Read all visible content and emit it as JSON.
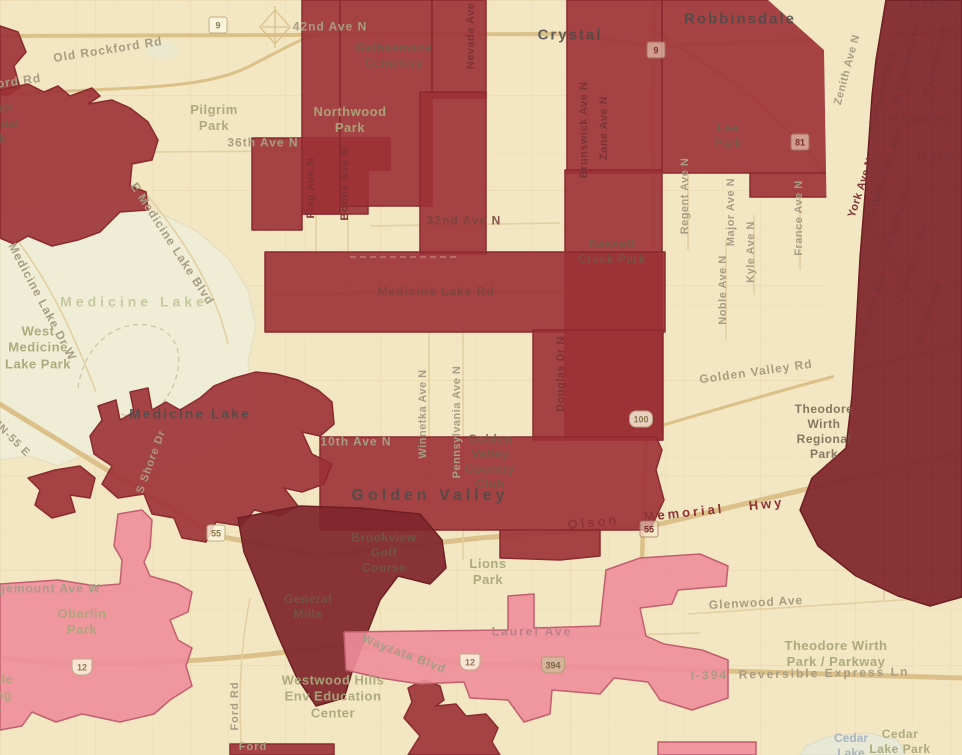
{
  "map": {
    "description": "Choropleth overlay map of Golden Valley / Crystal / Robbinsdale / Medicine Lake, Minnesota area",
    "palette": {
      "base": "#f3e6c2",
      "water": "#f0edd6",
      "region_red": "#9c3136",
      "region_red_stroke": "#8a2b30",
      "region_maroon": "#7f262c",
      "region_pink": "#ee8d9b",
      "region_pink_stroke": "#c05f6e",
      "road": "#dcc089",
      "grid": "#e8d6aa"
    }
  },
  "labels": [
    {
      "text": "Crystal",
      "x": 570,
      "y": 36,
      "rot": 0,
      "type": "city"
    },
    {
      "text": "Robbinsdale",
      "x": 740,
      "y": 20,
      "rot": 0,
      "type": "city"
    },
    {
      "text": "Medicine Lake",
      "x": 190,
      "y": 414,
      "rot": 0,
      "type": "city",
      "size": 14
    },
    {
      "text": "Golden Valley",
      "x": 430,
      "y": 496,
      "rot": 0,
      "type": "city",
      "ls": 4,
      "size": 16
    },
    {
      "text": "Pilgrim\nPark",
      "x": 214,
      "y": 118,
      "rot": 0,
      "type": "park"
    },
    {
      "text": "Northwood\nPark",
      "x": 350,
      "y": 120,
      "rot": 0,
      "type": "park"
    },
    {
      "text": "Gethsemane\nCemetery",
      "x": 394,
      "y": 56,
      "rot": 0,
      "type": "park-dark"
    },
    {
      "text": "Lee\nPark",
      "x": 728,
      "y": 136,
      "rot": 0,
      "type": "park-dark"
    },
    {
      "text": "Bassett\nCreek Park",
      "x": 612,
      "y": 252,
      "rot": 0,
      "type": "park-dark"
    },
    {
      "text": "West\nMedicine\nLake Park",
      "x": 38,
      "y": 348,
      "rot": 0,
      "type": "park"
    },
    {
      "text": "Golden\nValley\nCountry\nClub",
      "x": 490,
      "y": 462,
      "rot": 0,
      "type": "park-dark"
    },
    {
      "text": "Theodore\nWirth\nRegional\nPark",
      "x": 824,
      "y": 432,
      "rot": 0,
      "type": "park-dark"
    },
    {
      "text": "Brookview\nGolf\nCourse",
      "x": 384,
      "y": 553,
      "rot": 0,
      "type": "park-dark"
    },
    {
      "text": "Lions\nPark",
      "x": 488,
      "y": 572,
      "rot": 0,
      "type": "park"
    },
    {
      "text": "General\nMills",
      "x": 308,
      "y": 607,
      "rot": 0,
      "type": "park-dark"
    },
    {
      "text": "Westwood Hills\nEnv Education\nCenter",
      "x": 333,
      "y": 697,
      "rot": 0,
      "type": "park"
    },
    {
      "text": "Theodore Wirth\nPark / Parkway",
      "x": 836,
      "y": 654,
      "rot": 0,
      "type": "park"
    },
    {
      "text": "Oberlin\nPark",
      "x": 82,
      "y": 622,
      "rot": 0,
      "type": "park"
    },
    {
      "text": "French\nRegional\nPark",
      "x": -8,
      "y": 124,
      "rot": 0,
      "type": "park-dark"
    },
    {
      "text": "Ridgedale\nShopping\nCenter",
      "x": -20,
      "y": 696,
      "rot": 0,
      "type": "park"
    },
    {
      "text": "Medicine Lake",
      "x": 134,
      "y": 302,
      "rot": 0,
      "type": "lake"
    },
    {
      "text": "Cedar\nLake",
      "x": 851,
      "y": 746,
      "rot": 0,
      "type": "lake-blue"
    },
    {
      "text": "Cedar\nLake Park",
      "x": 900,
      "y": 742,
      "rot": 0,
      "type": "park",
      "size": 12
    },
    {
      "text": "Rockford Rd",
      "x": 0,
      "y": 84,
      "rot": -8,
      "type": "road"
    },
    {
      "text": "Old Rockford Rd",
      "x": 108,
      "y": 50,
      "rot": -9,
      "type": "road"
    },
    {
      "text": "42nd Ave N",
      "x": 330,
      "y": 27,
      "rot": 0,
      "type": "road"
    },
    {
      "text": "36th Ave N",
      "x": 263,
      "y": 143,
      "rot": 0,
      "type": "road"
    },
    {
      "text": "32nd Ave N",
      "x": 464,
      "y": 221,
      "rot": 0,
      "type": "road-red"
    },
    {
      "text": "Medicine Lake Rd",
      "x": 436,
      "y": 292,
      "rot": 0,
      "type": "road-red"
    },
    {
      "text": "Golden Valley Rd",
      "x": 756,
      "y": 372,
      "rot": -8,
      "type": "road"
    },
    {
      "text": "Olson Memorial Hwy",
      "x": 676,
      "y": 514,
      "rot": -6,
      "type": "hwy"
    },
    {
      "text": "Wayzata Blvd",
      "x": 404,
      "y": 654,
      "rot": 21,
      "type": "road"
    },
    {
      "text": "Laurel Ave",
      "x": 532,
      "y": 632,
      "rot": 0,
      "type": "road-pink"
    },
    {
      "text": "Glenwood Ave",
      "x": 756,
      "y": 603,
      "rot": -3,
      "type": "road"
    },
    {
      "text": "I-394  Reversible Express Ln",
      "x": 800,
      "y": 674,
      "rot": -1,
      "type": "road",
      "ls": 2
    },
    {
      "text": "Ridgemount Ave W",
      "x": 38,
      "y": 589,
      "rot": 0,
      "type": "road"
    },
    {
      "text": "Ford Rd",
      "x": 236,
      "y": 706,
      "rot": -90,
      "type": "road",
      "size": 11
    },
    {
      "text": "Ford",
      "x": 253,
      "y": 748,
      "rot": 0,
      "type": "road",
      "size": 11
    },
    {
      "text": "E Medicine Lake Blvd",
      "x": 172,
      "y": 244,
      "rot": 57,
      "type": "road"
    },
    {
      "text": "Medicine Lake Dr W",
      "x": 42,
      "y": 302,
      "rot": 62,
      "type": "road"
    },
    {
      "text": "MN-55 E",
      "x": 10,
      "y": 438,
      "rot": 45,
      "type": "road",
      "size": 11
    },
    {
      "text": "S Shore Dr",
      "x": 152,
      "y": 462,
      "rot": -70,
      "type": "road",
      "size": 11
    },
    {
      "text": "10th Ave N",
      "x": 356,
      "y": 442,
      "rot": 0,
      "type": "road"
    },
    {
      "text": "N Dowling",
      "x": 920,
      "y": 120,
      "rot": -3,
      "type": "street-red"
    },
    {
      "text": "N 44th",
      "x": 928,
      "y": 7,
      "rot": -3,
      "type": "street-red"
    },
    {
      "text": "N 36th",
      "x": 936,
      "y": 158,
      "rot": -3,
      "type": "street-red"
    },
    {
      "text": "Flag Ave N",
      "x": 312,
      "y": 188,
      "rot": -90,
      "type": "street-red"
    },
    {
      "text": "Boone Ave N",
      "x": 346,
      "y": 184,
      "rot": -90,
      "type": "street-red"
    },
    {
      "text": "Nevada Ave N",
      "x": 472,
      "y": 30,
      "rot": -90,
      "type": "street-red"
    },
    {
      "text": "Winnetka Ave N",
      "x": 424,
      "y": 414,
      "rot": -90,
      "type": "street"
    },
    {
      "text": "Pennsylvania Ave N",
      "x": 458,
      "y": 422,
      "rot": -90,
      "type": "street"
    },
    {
      "text": "Douglas Dr N",
      "x": 562,
      "y": 374,
      "rot": -90,
      "type": "street-red"
    },
    {
      "text": "Brunswick Ave N",
      "x": 585,
      "y": 130,
      "rot": -90,
      "type": "street-red"
    },
    {
      "text": "Zane Ave N",
      "x": 605,
      "y": 128,
      "rot": -90,
      "type": "street-red"
    },
    {
      "text": "Regent Ave N",
      "x": 686,
      "y": 196,
      "rot": -90,
      "type": "street"
    },
    {
      "text": "Major Ave N",
      "x": 732,
      "y": 212,
      "rot": -90,
      "type": "street"
    },
    {
      "text": "Kyle Ave N",
      "x": 752,
      "y": 252,
      "rot": -90,
      "type": "street"
    },
    {
      "text": "Noble Ave N",
      "x": 724,
      "y": 290,
      "rot": -90,
      "type": "street"
    },
    {
      "text": "France Ave N",
      "x": 800,
      "y": 218,
      "rot": -90,
      "type": "street"
    },
    {
      "text": "York Ave N",
      "x": 862,
      "y": 188,
      "rot": -72,
      "type": "street-red"
    },
    {
      "text": "Zenith Ave N",
      "x": 848,
      "y": 70,
      "rot": -75,
      "type": "street"
    },
    {
      "text": "Xerxes Ave N",
      "x": 884,
      "y": 88,
      "rot": -75,
      "type": "street-red"
    },
    {
      "text": "N Thomas Ave",
      "x": 908,
      "y": 64,
      "rot": -75,
      "type": "street-red"
    },
    {
      "text": "N Queen Ave",
      "x": 936,
      "y": 62,
      "rot": -75,
      "type": "street-red"
    },
    {
      "text": "N Washburn Ave",
      "x": 886,
      "y": 174,
      "rot": -72,
      "type": "street-red"
    },
    {
      "text": "N Upton Ave",
      "x": 900,
      "y": 214,
      "rot": -72,
      "type": "street-red"
    },
    {
      "text": "N Sheridan Ave",
      "x": 914,
      "y": 264,
      "rot": -72,
      "type": "street-red"
    },
    {
      "text": "N Penn Ave",
      "x": 930,
      "y": 314,
      "rot": -72,
      "type": "street-red"
    },
    {
      "text": "N Vincent Ave",
      "x": 872,
      "y": 312,
      "rot": -72,
      "type": "street-red"
    }
  ],
  "shields": [
    {
      "num": "9",
      "x": 218,
      "y": 25,
      "kind": "sq"
    },
    {
      "num": "9",
      "x": 656,
      "y": 50,
      "kind": "sq-red"
    },
    {
      "num": "81",
      "x": 800,
      "y": 142,
      "kind": "sq-red"
    },
    {
      "num": "100",
      "x": 641,
      "y": 419,
      "kind": "pill"
    },
    {
      "num": "55",
      "x": 216,
      "y": 533,
      "kind": "sq"
    },
    {
      "num": "55",
      "x": 649,
      "y": 529,
      "kind": "sq-red"
    },
    {
      "num": "12",
      "x": 82,
      "y": 667,
      "kind": "us"
    },
    {
      "num": "12",
      "x": 470,
      "y": 662,
      "kind": "us"
    },
    {
      "num": "394",
      "x": 553,
      "y": 665,
      "kind": "int"
    }
  ]
}
